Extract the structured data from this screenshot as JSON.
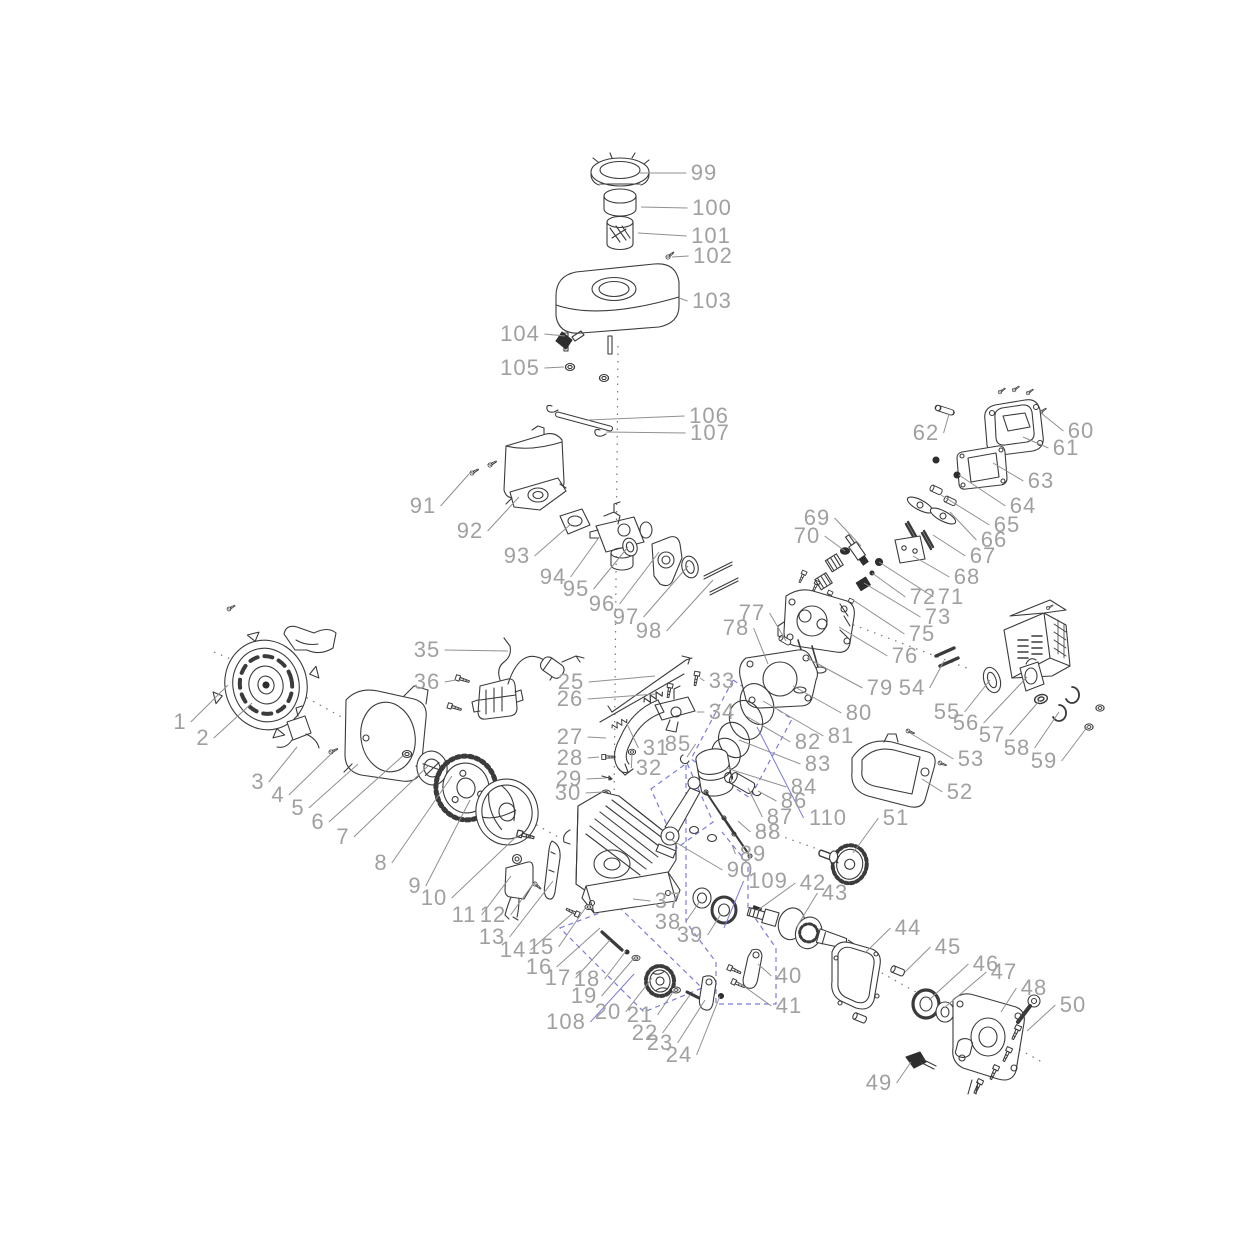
{
  "diagram": {
    "type": "exploded-parts-diagram",
    "subject": "small-gasoline-engine",
    "background_color": "#ffffff",
    "label_color": "#a0a0a0",
    "leader_color": "#909090",
    "group_outline_color": "#7b7bdb",
    "part_count_note": "numbered callouts 1-110 (74 not shown)",
    "labels": [
      {
        "n": "1",
        "x": 180,
        "y": 722,
        "tx": 228,
        "ty": 685
      },
      {
        "n": "2",
        "x": 203,
        "y": 738,
        "tx": 252,
        "ty": 703
      },
      {
        "n": "3",
        "x": 258,
        "y": 782,
        "tx": 297,
        "ty": 747
      },
      {
        "n": "4",
        "x": 278,
        "y": 795,
        "tx": 332,
        "ty": 753
      },
      {
        "n": "5",
        "x": 298,
        "y": 808,
        "tx": 358,
        "ty": 764
      },
      {
        "n": "6",
        "x": 318,
        "y": 822,
        "tx": 405,
        "ty": 754
      },
      {
        "n": "7",
        "x": 343,
        "y": 837,
        "tx": 428,
        "ty": 766
      },
      {
        "n": "8",
        "x": 381,
        "y": 863,
        "tx": 452,
        "ty": 776
      },
      {
        "n": "9",
        "x": 415,
        "y": 886,
        "tx": 470,
        "ty": 800
      },
      {
        "n": "10",
        "x": 434,
        "y": 898,
        "tx": 518,
        "ty": 835
      },
      {
        "n": "11",
        "x": 464,
        "y": 915,
        "tx": 511,
        "ty": 876
      },
      {
        "n": "12",
        "x": 493,
        "y": 915,
        "tx": 533,
        "ty": 884
      },
      {
        "n": "13",
        "x": 492,
        "y": 937,
        "tx": 553,
        "ty": 881
      },
      {
        "n": "14",
        "x": 513,
        "y": 950,
        "tx": 574,
        "ty": 912
      },
      {
        "n": "15",
        "x": 541,
        "y": 947,
        "tx": 586,
        "ty": 907
      },
      {
        "n": "16",
        "x": 539,
        "y": 967,
        "tx": 600,
        "ty": 928
      },
      {
        "n": "17",
        "x": 558,
        "y": 978,
        "tx": 610,
        "ty": 940
      },
      {
        "n": "18",
        "x": 587,
        "y": 979,
        "tx": 626,
        "ty": 951
      },
      {
        "n": "19",
        "x": 584,
        "y": 996,
        "tx": 635,
        "ty": 957
      },
      {
        "n": "20",
        "x": 608,
        "y": 1012,
        "tx": 652,
        "ty": 978
      },
      {
        "n": "21",
        "x": 640,
        "y": 1015,
        "tx": 675,
        "ty": 989
      },
      {
        "n": "22",
        "x": 645,
        "y": 1033,
        "tx": 690,
        "ty": 995
      },
      {
        "n": "23",
        "x": 660,
        "y": 1043,
        "tx": 705,
        "ty": 1000
      },
      {
        "n": "24",
        "x": 679,
        "y": 1055,
        "tx": 720,
        "ty": 996
      },
      {
        "n": "25",
        "x": 571,
        "y": 682,
        "tx": 655,
        "ty": 676
      },
      {
        "n": "26",
        "x": 570,
        "y": 699,
        "tx": 656,
        "ty": 694
      },
      {
        "n": "27",
        "x": 570,
        "y": 737,
        "tx": 606,
        "ty": 738
      },
      {
        "n": "28",
        "x": 570,
        "y": 758,
        "tx": 599,
        "ty": 757
      },
      {
        "n": "29",
        "x": 569,
        "y": 779,
        "tx": 606,
        "ty": 778
      },
      {
        "n": "30",
        "x": 568,
        "y": 793,
        "tx": 603,
        "ty": 792
      },
      {
        "n": "31",
        "x": 656,
        "y": 748,
        "tx": 627,
        "ty": 724
      },
      {
        "n": "32",
        "x": 649,
        "y": 768,
        "tx": 632,
        "ty": 753
      },
      {
        "n": "33",
        "x": 722,
        "y": 681,
        "tx": 700,
        "ty": 678
      },
      {
        "n": "34",
        "x": 722,
        "y": 712,
        "tx": 697,
        "ty": 712
      },
      {
        "n": "35",
        "x": 427,
        "y": 650,
        "tx": 508,
        "ty": 651
      },
      {
        "n": "36",
        "x": 427,
        "y": 682,
        "tx": 456,
        "ty": 680
      },
      {
        "n": "37",
        "x": 668,
        "y": 901,
        "tx": 633,
        "ty": 899
      },
      {
        "n": "38",
        "x": 668,
        "y": 922,
        "tx": 700,
        "ty": 901
      },
      {
        "n": "39",
        "x": 690,
        "y": 935,
        "tx": 721,
        "ty": 914
      },
      {
        "n": "40",
        "x": 789,
        "y": 976,
        "tx": 758,
        "ty": 964
      },
      {
        "n": "41",
        "x": 789,
        "y": 1006,
        "tx": 738,
        "ty": 982
      },
      {
        "n": "42",
        "x": 813,
        "y": 883,
        "tx": 758,
        "ty": 910
      },
      {
        "n": "43",
        "x": 835,
        "y": 893,
        "tx": 796,
        "ty": 928
      },
      {
        "n": "44",
        "x": 908,
        "y": 928,
        "tx": 865,
        "ty": 953
      },
      {
        "n": "45",
        "x": 948,
        "y": 947,
        "tx": 905,
        "ty": 972
      },
      {
        "n": "46",
        "x": 986,
        "y": 964,
        "tx": 929,
        "ty": 1000
      },
      {
        "n": "47",
        "x": 1004,
        "y": 972,
        "tx": 944,
        "ty": 1008
      },
      {
        "n": "48",
        "x": 1034,
        "y": 988,
        "tx": 1001,
        "ty": 1012
      },
      {
        "n": "49",
        "x": 879,
        "y": 1083,
        "tx": 911,
        "ty": 1062
      },
      {
        "n": "50",
        "x": 1073,
        "y": 1005,
        "tx": 1027,
        "ty": 1031
      },
      {
        "n": "51",
        "x": 896,
        "y": 818,
        "tx": 853,
        "ty": 853
      },
      {
        "n": "52",
        "x": 960,
        "y": 792,
        "tx": 922,
        "ty": 779
      },
      {
        "n": "53",
        "x": 971,
        "y": 759,
        "tx": 910,
        "ty": 733
      },
      {
        "n": "54",
        "x": 912,
        "y": 688,
        "tx": 944,
        "ty": 661
      },
      {
        "n": "55",
        "x": 947,
        "y": 712,
        "tx": 990,
        "ty": 680
      },
      {
        "n": "56",
        "x": 966,
        "y": 723,
        "tx": 1027,
        "ty": 677
      },
      {
        "n": "57",
        "x": 992,
        "y": 735,
        "tx": 1040,
        "ty": 700
      },
      {
        "n": "58",
        "x": 1017,
        "y": 748,
        "tx": 1059,
        "ty": 712
      },
      {
        "n": "59",
        "x": 1044,
        "y": 761,
        "tx": 1088,
        "ty": 726
      },
      {
        "n": "60",
        "x": 1081,
        "y": 431,
        "tx": 1041,
        "ty": 413
      },
      {
        "n": "61",
        "x": 1066,
        "y": 448,
        "tx": 1023,
        "ty": 437
      },
      {
        "n": "62",
        "x": 926,
        "y": 433,
        "tx": 949,
        "ty": 414
      },
      {
        "n": "63",
        "x": 1041,
        "y": 481,
        "tx": 993,
        "ty": 463
      },
      {
        "n": "64",
        "x": 1023,
        "y": 506,
        "tx": 959,
        "ty": 475
      },
      {
        "n": "65",
        "x": 1007,
        "y": 525,
        "tx": 941,
        "ty": 495
      },
      {
        "n": "66",
        "x": 994,
        "y": 540,
        "tx": 950,
        "ty": 512
      },
      {
        "n": "67",
        "x": 983,
        "y": 556,
        "tx": 933,
        "ty": 535
      },
      {
        "n": "68",
        "x": 967,
        "y": 577,
        "tx": 913,
        "ty": 556
      },
      {
        "n": "69",
        "x": 817,
        "y": 518,
        "tx": 861,
        "ty": 546
      },
      {
        "n": "70",
        "x": 807,
        "y": 536,
        "tx": 845,
        "ty": 551
      },
      {
        "n": "71",
        "x": 951,
        "y": 597,
        "tx": 879,
        "ty": 562
      },
      {
        "n": "72",
        "x": 923,
        "y": 597,
        "tx": 872,
        "ty": 573
      },
      {
        "n": "73",
        "x": 938,
        "y": 617,
        "tx": 864,
        "ty": 583
      },
      {
        "n": "75",
        "x": 922,
        "y": 634,
        "tx": 853,
        "ty": 600
      },
      {
        "n": "76",
        "x": 905,
        "y": 656,
        "tx": 839,
        "ty": 627
      },
      {
        "n": "77",
        "x": 752,
        "y": 613,
        "tx": 786,
        "ty": 641
      },
      {
        "n": "78",
        "x": 736,
        "y": 628,
        "tx": 768,
        "ty": 664
      },
      {
        "n": "79",
        "x": 880,
        "y": 688,
        "tx": 807,
        "ty": 658
      },
      {
        "n": "80",
        "x": 859,
        "y": 713,
        "tx": 793,
        "ty": 686
      },
      {
        "n": "81",
        "x": 841,
        "y": 736,
        "tx": 763,
        "ty": 701
      },
      {
        "n": "82",
        "x": 808,
        "y": 742,
        "tx": 746,
        "ty": 716
      },
      {
        "n": "83",
        "x": 818,
        "y": 764,
        "tx": 739,
        "ty": 740
      },
      {
        "n": "84",
        "x": 804,
        "y": 787,
        "tx": 726,
        "ty": 768
      },
      {
        "n": "85",
        "x": 678,
        "y": 744,
        "tx": 687,
        "ty": 757
      },
      {
        "n": "86",
        "x": 794,
        "y": 801,
        "tx": 758,
        "ty": 791
      },
      {
        "n": "87",
        "x": 780,
        "y": 817,
        "tx": 748,
        "ty": 788
      },
      {
        "n": "88",
        "x": 768,
        "y": 832,
        "tx": 738,
        "ty": 821
      },
      {
        "n": "89",
        "x": 753,
        "y": 854,
        "tx": 732,
        "ty": 845
      },
      {
        "n": "90",
        "x": 740,
        "y": 870,
        "tx": 670,
        "ty": 839
      },
      {
        "n": "91",
        "x": 423,
        "y": 506,
        "tx": 469,
        "ty": 474
      },
      {
        "n": "92",
        "x": 470,
        "y": 531,
        "tx": 519,
        "ty": 497
      },
      {
        "n": "93",
        "x": 517,
        "y": 556,
        "tx": 571,
        "ty": 524
      },
      {
        "n": "94",
        "x": 553,
        "y": 577,
        "tx": 600,
        "ty": 536
      },
      {
        "n": "95",
        "x": 576,
        "y": 589,
        "tx": 628,
        "ty": 547
      },
      {
        "n": "96",
        "x": 602,
        "y": 604,
        "tx": 659,
        "ty": 552
      },
      {
        "n": "97",
        "x": 626,
        "y": 617,
        "tx": 688,
        "ty": 566
      },
      {
        "n": "98",
        "x": 649,
        "y": 631,
        "tx": 713,
        "ty": 580
      },
      {
        "n": "99",
        "x": 704,
        "y": 173,
        "tx": 640,
        "ty": 173
      },
      {
        "n": "100",
        "x": 712,
        "y": 208,
        "tx": 641,
        "ty": 207
      },
      {
        "n": "101",
        "x": 711,
        "y": 236,
        "tx": 638,
        "ty": 233
      },
      {
        "n": "102",
        "x": 713,
        "y": 256,
        "tx": 672,
        "ty": 257
      },
      {
        "n": "103",
        "x": 712,
        "y": 301,
        "tx": 679,
        "ty": 298
      },
      {
        "n": "104",
        "x": 520,
        "y": 334,
        "tx": 565,
        "ty": 336
      },
      {
        "n": "105",
        "x": 520,
        "y": 368,
        "tx": 564,
        "ty": 367
      },
      {
        "n": "106",
        "x": 709,
        "y": 416,
        "tx": 588,
        "ty": 420
      },
      {
        "n": "107",
        "x": 710,
        "y": 433,
        "tx": 606,
        "ty": 432
      },
      {
        "n": "108",
        "x": 566,
        "y": 1022,
        "tx": 634,
        "ty": 974,
        "blue": true
      },
      {
        "n": "109",
        "x": 768,
        "y": 881,
        "tx": 724,
        "ty": 928,
        "blue": true
      },
      {
        "n": "110",
        "x": 828,
        "y": 818,
        "tx": 757,
        "ty": 727,
        "blue": true
      }
    ]
  }
}
